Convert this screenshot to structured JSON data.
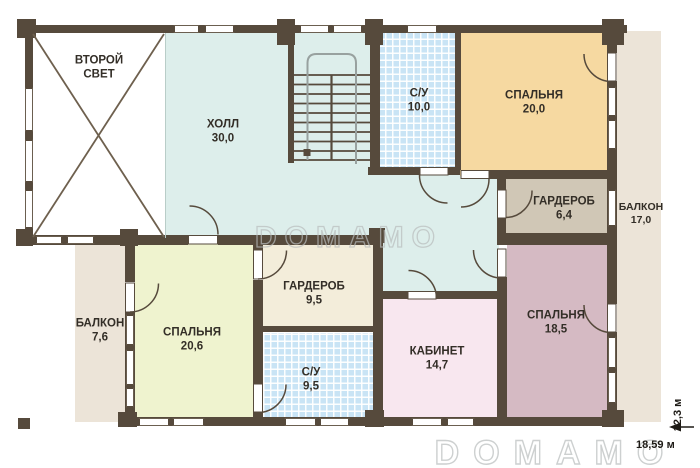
{
  "plan": {
    "floor_note": "second floor plan",
    "rooms": [
      {
        "name": "ВТОРОЙ СВЕТ",
        "area": ""
      },
      {
        "name": "ХОЛЛ",
        "area": "30,0"
      },
      {
        "name": "С/У",
        "area": "10,0"
      },
      {
        "name": "СПАЛЬНЯ",
        "area": "20,0"
      },
      {
        "name": "ГАРДЕРОБ",
        "area": "6,4"
      },
      {
        "name": "БАЛКОН",
        "area": "17,0"
      },
      {
        "name": "БАЛКОН",
        "area": "7,6"
      },
      {
        "name": "СПАЛЬНЯ",
        "area": "20,6"
      },
      {
        "name": "ГАРДЕРОБ",
        "area": "9,5"
      },
      {
        "name": "С/У",
        "area": "9,5"
      },
      {
        "name": "КАБИНЕТ",
        "area": "14,7"
      },
      {
        "name": "СПАЛЬНЯ",
        "area": "18,5"
      }
    ],
    "dimensions": {
      "width": "18,59 м",
      "height": "12,3 м"
    },
    "watermark": {
      "text": "DOMAMO"
    },
    "colors": {
      "wall": "#564a3c",
      "hall": "#ddeeeb",
      "tiles": "#c9e4f5",
      "bedroom_20": "#f6d9a1",
      "wardrobe_64": "#d0c7b6",
      "balcony": "#ece4d8",
      "bedroom_206": "#eff3cf",
      "wardrobe_95": "#f3edda",
      "office": "#f8e7ef",
      "bedroom_185": "#d5bac3",
      "watermark": "#b9bdbd",
      "text": "#332e27"
    }
  }
}
